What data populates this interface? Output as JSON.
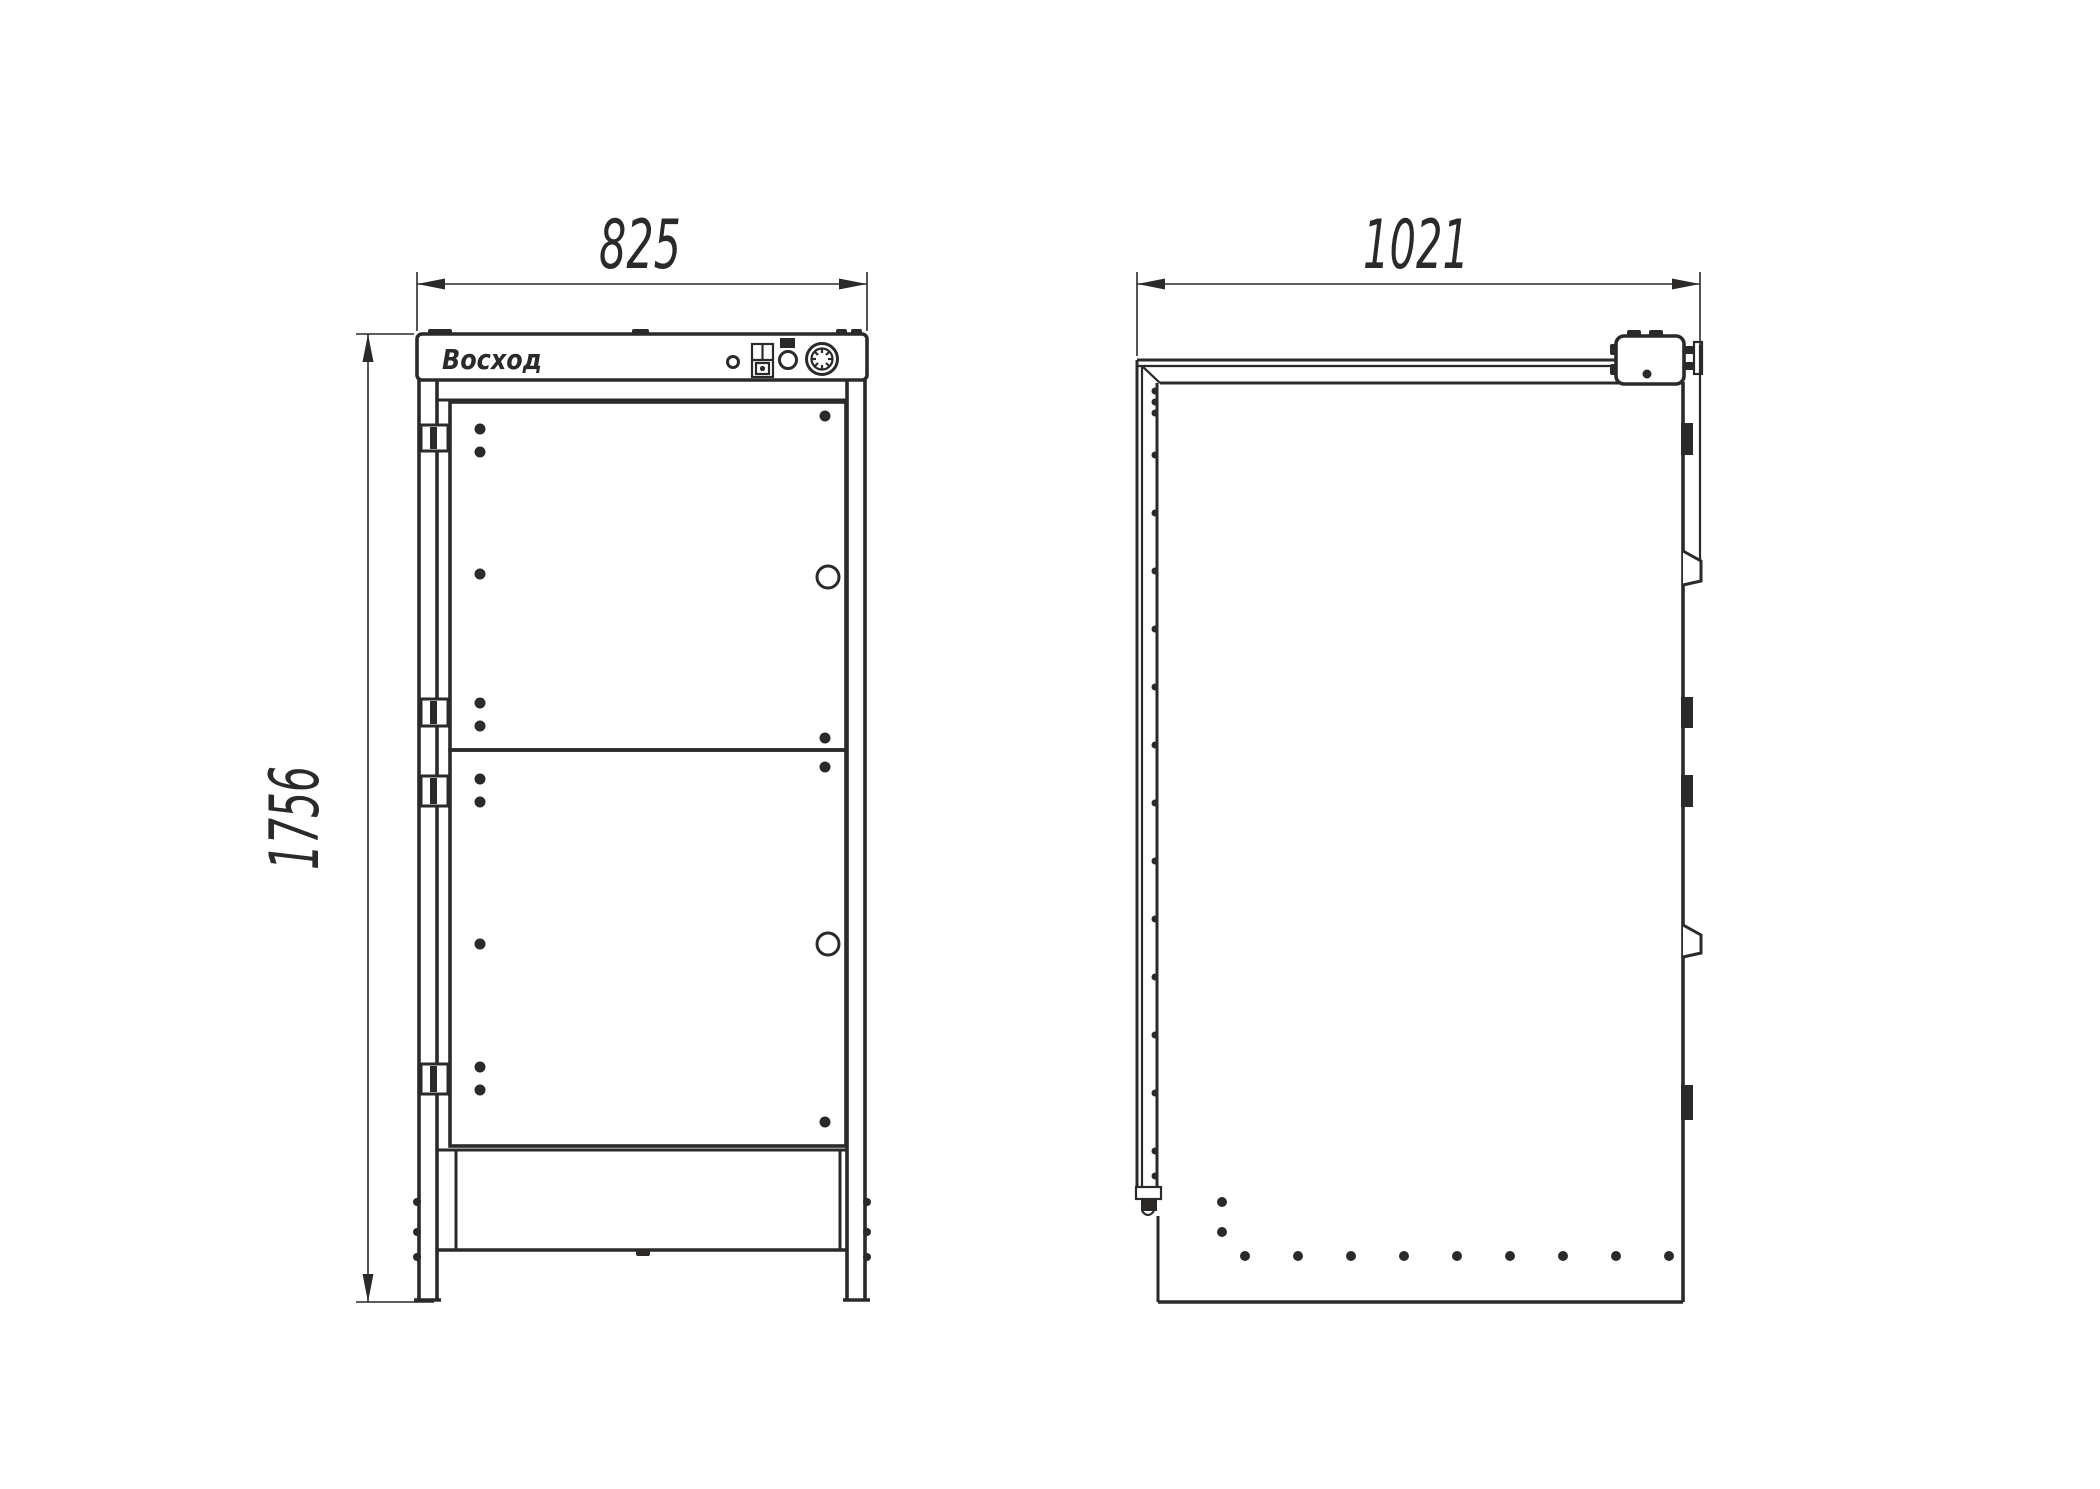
{
  "drawing": {
    "background_color": "#ffffff",
    "line_color": "#2b2a29",
    "brand_logo": "Восход",
    "dimensions": {
      "width_mm": "825",
      "depth_mm": "1021",
      "height_mm": "1756"
    }
  }
}
